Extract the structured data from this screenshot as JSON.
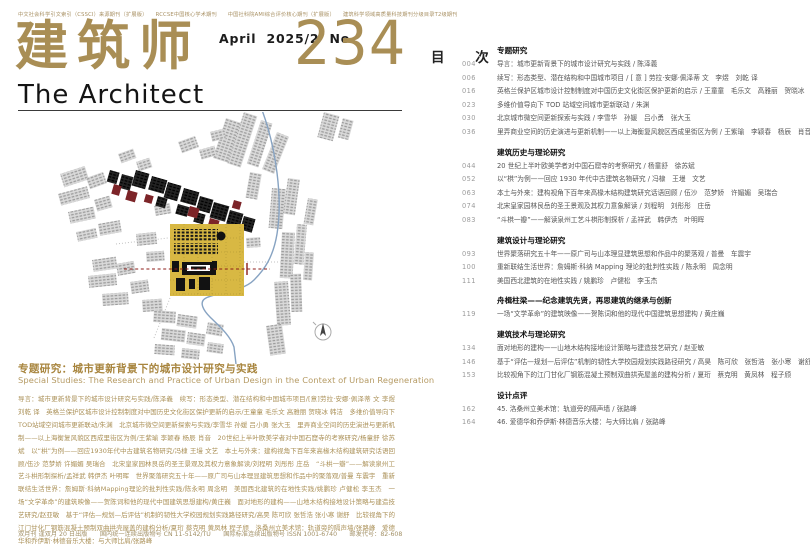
{
  "journal": {
    "accreditation": "中文社会科学引文索引（CSSCI）来源期刊（扩展版）　　RCCSE中国核心学术期刊　　中国社科院AMI综合评价核心期刊（扩展版）　　建筑科学领域高质量科技期刊分级目录T2级期刊",
    "title_cn": "建筑师",
    "title_en": "The Architect",
    "issue_date": "April 2025/2",
    "no_label": "No.",
    "issue_number": "234"
  },
  "cover": {
    "feature_title": "专题研究：城市更新背景下的城市设计研究与实践",
    "feature_subtitle_en": "Special Studies:  The Research and Practice of Urban Design in the Context of Urban Regeneration",
    "summary": "导言：城市更新背景下的城市设计研究与实践/陈泽義　续写：形态类型、潜在结构和中国城市项目/[意]劳拉·安娜·佩泽蒂 文 李煜 刘乾 译　英格兰保护区城市设计控制制度对中国历史文化街区保护更新的启示/王童童 毛乐文 高雅丽 贺晓冰 韩洁　多维价值导向下TOD站域空间城市更新联动/朱渊　北京城市微空间更新探索与实践/李雪华 孙媛 吕小勇 张大玉　里弄商业空间的历史演进与更新机制——以上海衡复风貌区西成里街区为例/王紫瑜 李颖春 杨辰 肖音　20世纪上半叶欧美学者对中国石窟寺的考察研究/杨童舒 徐苏斌　以“栱”为例——回应1930年代中古建筑名物研究/冯棣 王墁 文艺　本土与外来：建构视角下百年来高椽木结构建筑研究话语回顾/伍沙 范梦娇 许媚媚 吴瑞合　北宋皇家园林艮岳的圣王景观及其权力意象解读/刘程明 刘彤彤 庄岳　“斗栱一瓣”——解读泉州工艺斗栱形制探析/孟祥武 韩伊杰 叶明晖　世界聚落研究五十年——原广司与山本理显建筑思想和作品中的聚落观/普曼 车震宇　重新联结生活世界：詹姆斯·科纳Mapping理论的批判性实践/陈永明 周念明　美国西北建筑的在地性实践/姚鹏珍 卢健松 李玉杰　一场“文学革命”的建筑映像——贺陈词和他的现代中国建筑思想建构/黄庄巍　面对地形的建构——山地木结构接地设计策略与建造技艺研究/赵亚敏　基于“评估—规划—后评估”机制的韧性大学校园规划实践路径研究/高昊 陈可欣 张哲浩 张小寒 谢舒　比较视角下的江门甘化厂钢筋混凝土预制双曲拱壳屋盖的建构分析/夏珩 蔡克明 黄凤林 程子颀　洛桑州立美术馆：轨道旁的隔声墙/张路峰　爱德华和乔伊斯·林德音乐大楼：与大师比肩/张路峰",
    "footer": "双月刊 逢双月 20 日出版　　国内统一连续出版物号 CN 11-5142/TU　　国际标准连续出版物号 ISSN 1001-6740　　邮发代号：82-608"
  },
  "toc": {
    "title": "目 次",
    "sections": [
      {
        "heading": "专题研究",
        "entries": [
          {
            "page": "004",
            "text": "导言：城市更新背景下的城市设计研究与实践 / 陈泽義"
          },
          {
            "page": "006",
            "text": "续写：形态类型、潜在结构和中国城市项目 / [ 意 ] 劳拉·安娜·佩泽蒂 文　李煜　刘乾 译"
          },
          {
            "page": "016",
            "text": "英格兰保护区城市设计控制制度对中国历史文化街区保护更新的启示 / 王童童　毛乐文　高雅丽　贺晓冰　韩洁"
          },
          {
            "page": "023",
            "text": "多维价值导向下 TOD 站域空间城市更新联动 / 朱渊"
          },
          {
            "page": "030",
            "text": "北京城市微空间更新探索与实践 / 李雪华　孙媛　吕小勇　张大玉"
          },
          {
            "page": "036",
            "text": "里弄商业空间的历史演进与更新机制——以上海衡复风貌区西成里街区为例 / 王紫瑜　李颖春　杨辰　肖音"
          }
        ]
      },
      {
        "heading": "建筑历史与理论研究",
        "entries": [
          {
            "page": "044",
            "text": "20 世纪上半叶欧美学者对中国石窟寺的考察研究 / 杨童舒　徐苏斌"
          },
          {
            "page": "052",
            "text": "以“栱”为例——回应 1930 年代中古建筑名物研究 / 冯棣　王墁　文艺"
          },
          {
            "page": "063",
            "text": "本土与外来：建构视角下百年来高椽木结构建筑研究话语回顾 / 伍沙　范梦娇　许媚媚　吴瑞合"
          },
          {
            "page": "074",
            "text": "北宋皇家园林艮岳的圣王景观及其权力意象解读 / 刘程明　刘彤彤　庄岳"
          },
          {
            "page": "083",
            "text": "“斗栱一瓣”——解读泉州工艺斗栱形制探析 / 孟祥武　韩伊杰　叶明晖"
          }
        ]
      },
      {
        "heading": "建筑设计与理论研究",
        "entries": [
          {
            "page": "093",
            "text": "世界聚落研究五十年——原广司与山本理显建筑思想和作品中的聚落观 / 普曼　车震宇"
          },
          {
            "page": "100",
            "text": "重新联结生活世界：詹姆斯·科纳 Mapping 理论的批判性实践 / 陈永明　周念明"
          },
          {
            "page": "111",
            "text": "美国西北建筑的在地性实践 / 姚鹏珍　卢健松　李玉杰"
          }
        ]
      },
      {
        "heading": "舟楫柱梁——纪念建筑先贤，再思建筑的继承与创新",
        "entries": [
          {
            "page": "119",
            "text": "一场“文学革命”的建筑映像——贺陈词和他的现代中国建筑思想建构 / 黄庄巍"
          }
        ]
      },
      {
        "heading": "建筑技术与理论研究",
        "entries": [
          {
            "page": "134",
            "text": "面对地形的建构——山地木结构接地设计策略与建造技艺研究 / 赵亚敏"
          },
          {
            "page": "146",
            "text": "基于“评估—规划—后评估”机制的韧性大学校园规划实践路径研究 / 高昊　陈可欣　张哲浩　张小寒　谢舒"
          },
          {
            "page": "153",
            "text": "比较视角下的江门甘化厂钢筋混凝土预制双曲拱壳屋盖的建构分析 / 夏珩　蔡克明　黄凤林　程子颀"
          }
        ]
      },
      {
        "heading": "设计点评",
        "entries": [
          {
            "page": "162",
            "text": "45. 洛桑州立美术馆：轨道旁的隔声墙 / 张路峰"
          },
          {
            "page": "164",
            "text": "46. 爱德华和乔伊斯·林德音乐大楼：与大师比肩 / 张路峰"
          }
        ]
      }
    ]
  },
  "colors": {
    "gold": "#a98e55",
    "map_yellow": "#d8b843",
    "maroon": "#7c2428",
    "river_blue": "#87a3c2",
    "axis_red": "#8c1d18"
  }
}
